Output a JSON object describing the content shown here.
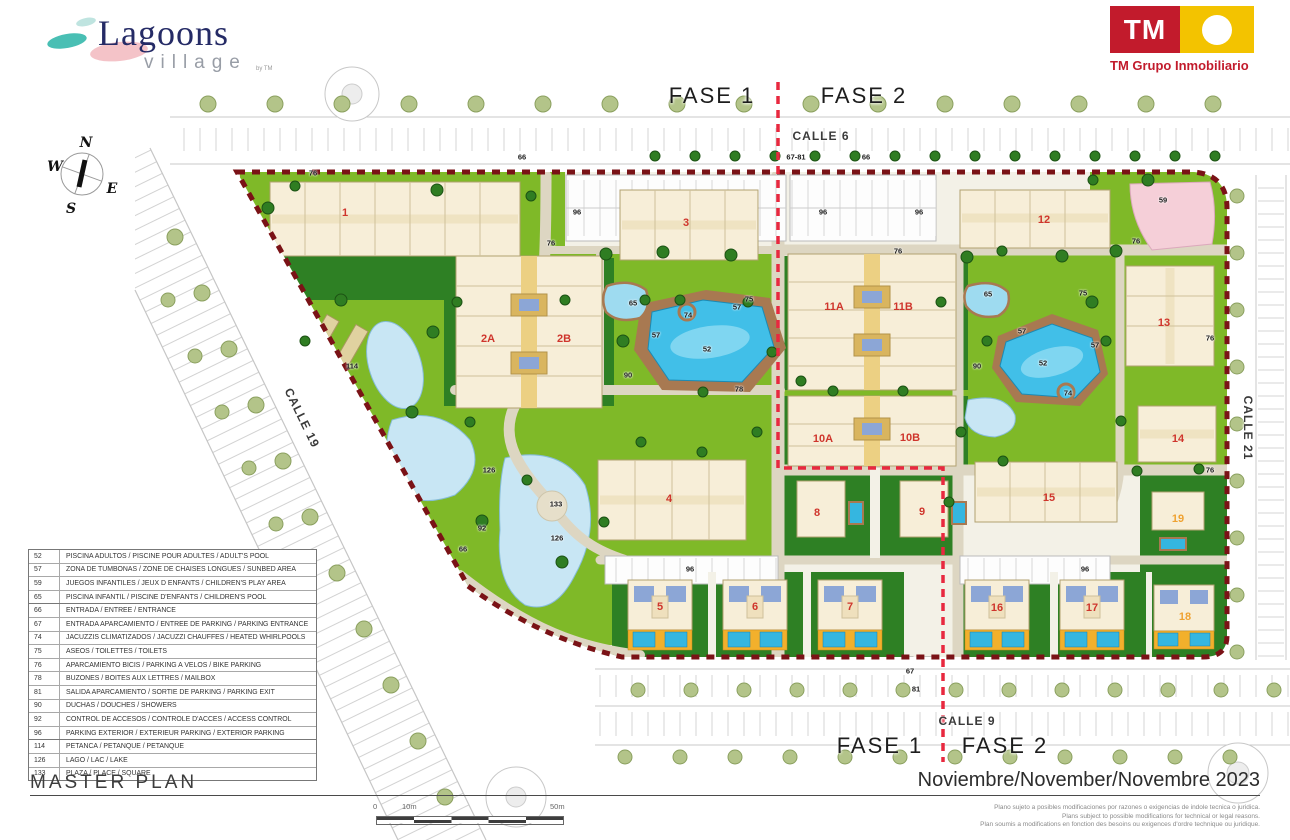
{
  "branding": {
    "lagoons_title": "Lagoons",
    "lagoons_subtitle": "village",
    "lagoons_by": "by TM",
    "tm_initials": "TM",
    "tm_company": "TM Grupo Inmobiliario"
  },
  "compass": {
    "n": "N",
    "w": "W",
    "e": "E",
    "s": "S"
  },
  "phases": {
    "top_left": "FASE 1",
    "top_right": "FASE 2",
    "bottom_left": "FASE 1",
    "bottom_right": "FASE 2"
  },
  "streets": {
    "top": "CALLE 6",
    "bottom": "CALLE 9",
    "left": "CALLE 19",
    "right": "CALLE 21"
  },
  "legend": {
    "items": [
      {
        "num": "52",
        "text": "PISCINA ADULTOS / PISCINE  POUR ADULTES / ADULT'S POOL"
      },
      {
        "num": "57",
        "text": "ZONA DE TUMBONAS / ZONE DE CHAISES LONGUES / SUNBED AREA"
      },
      {
        "num": "59",
        "text": "JUEGOS INFANTILES / JEUX D ENFANTS / CHILDREN'S PLAY AREA"
      },
      {
        "num": "65",
        "text": "PISCINA INFANTIL / PISCINE D'ENFANTS / CHILDREN'S POOL"
      },
      {
        "num": "66",
        "text": "ENTRADA / ENTREE / ENTRANCE"
      },
      {
        "num": "67",
        "text": "ENTRADA APARCAMIENTO / ENTREE DE PARKING / PARKING ENTRANCE"
      },
      {
        "num": "74",
        "text": "JACUZZIS CLIMATIZADOS / JACUZZI CHAUFFES / HEATED WHIRLPOOLS"
      },
      {
        "num": "75",
        "text": "ASEOS / TOILETTES / TOILETS"
      },
      {
        "num": "76",
        "text": "APARCAMIENTO BICIS / PARKING A VELOS / BIKE PARKING"
      },
      {
        "num": "78",
        "text": "BUZONES / BOITES AUX LETTRES / MAILBOX"
      },
      {
        "num": "81",
        "text": "SALIDA APARCAMIENTO / SORTIE DE PARKING / PARKING EXIT"
      },
      {
        "num": "90",
        "text": "DUCHAS / DOUCHES / SHOWERS"
      },
      {
        "num": "92",
        "text": "CONTROL DE ACCESOS / CONTROLE D'ACCES / ACCESS CONTROL"
      },
      {
        "num": "96",
        "text": "PARKING EXTERIOR / EXTERIEUR PARKING / EXTERIOR PARKING"
      },
      {
        "num": "114",
        "text": "PETANCA / PETANQUE / PETANQUE"
      },
      {
        "num": "126",
        "text": "LAGO / LAC / LAKE"
      },
      {
        "num": "133",
        "text": "PLAZA / PLACE / SQUARE"
      }
    ]
  },
  "map": {
    "building_labels": [
      {
        "label": "1",
        "x": 345,
        "y": 213
      },
      {
        "label": "2A",
        "x": 488,
        "y": 339
      },
      {
        "label": "2B",
        "x": 564,
        "y": 339
      },
      {
        "label": "3",
        "x": 686,
        "y": 223
      },
      {
        "label": "4",
        "x": 669,
        "y": 499
      },
      {
        "label": "5",
        "x": 660,
        "y": 607
      },
      {
        "label": "6",
        "x": 755,
        "y": 607
      },
      {
        "label": "7",
        "x": 850,
        "y": 607
      },
      {
        "label": "8",
        "x": 817,
        "y": 513
      },
      {
        "label": "9",
        "x": 922,
        "y": 512
      },
      {
        "label": "10A",
        "x": 823,
        "y": 439
      },
      {
        "label": "10B",
        "x": 910,
        "y": 438
      },
      {
        "label": "11A",
        "x": 834,
        "y": 307
      },
      {
        "label": "11B",
        "x": 903,
        "y": 307
      },
      {
        "label": "12",
        "x": 1044,
        "y": 220
      },
      {
        "label": "13",
        "x": 1164,
        "y": 323
      },
      {
        "label": "14",
        "x": 1178,
        "y": 439
      },
      {
        "label": "15",
        "x": 1049,
        "y": 498
      },
      {
        "label": "16",
        "x": 997,
        "y": 608
      },
      {
        "label": "17",
        "x": 1092,
        "y": 608
      },
      {
        "label": "18",
        "x": 1185,
        "y": 617,
        "accent": true
      },
      {
        "label": "19",
        "x": 1178,
        "y": 519,
        "accent": true
      }
    ],
    "markers": [
      {
        "label": "96",
        "x": 577,
        "y": 212
      },
      {
        "label": "96",
        "x": 823,
        "y": 212
      },
      {
        "label": "96",
        "x": 919,
        "y": 212
      },
      {
        "label": "96",
        "x": 690,
        "y": 569
      },
      {
        "label": "96",
        "x": 1085,
        "y": 569
      },
      {
        "label": "76",
        "x": 313,
        "y": 173
      },
      {
        "label": "76",
        "x": 551,
        "y": 243
      },
      {
        "label": "76",
        "x": 898,
        "y": 251
      },
      {
        "label": "76",
        "x": 1136,
        "y": 241
      },
      {
        "label": "76",
        "x": 1210,
        "y": 338
      },
      {
        "label": "76",
        "x": 1210,
        "y": 470
      },
      {
        "label": "66",
        "x": 522,
        "y": 157
      },
      {
        "label": "66",
        "x": 866,
        "y": 157
      },
      {
        "label": "66",
        "x": 463,
        "y": 549
      },
      {
        "label": "67-81",
        "x": 796,
        "y": 157
      },
      {
        "label": "67",
        "x": 910,
        "y": 671
      },
      {
        "label": "81",
        "x": 916,
        "y": 689
      },
      {
        "label": "52",
        "x": 707,
        "y": 349
      },
      {
        "label": "52",
        "x": 1043,
        "y": 363
      },
      {
        "label": "57",
        "x": 656,
        "y": 335
      },
      {
        "label": "57",
        "x": 737,
        "y": 307
      },
      {
        "label": "57",
        "x": 1022,
        "y": 331
      },
      {
        "label": "57",
        "x": 1095,
        "y": 345
      },
      {
        "label": "65",
        "x": 633,
        "y": 303
      },
      {
        "label": "65",
        "x": 988,
        "y": 294
      },
      {
        "label": "74",
        "x": 688,
        "y": 315
      },
      {
        "label": "74",
        "x": 1068,
        "y": 393
      },
      {
        "label": "75",
        "x": 749,
        "y": 299
      },
      {
        "label": "75",
        "x": 1083,
        "y": 293
      },
      {
        "label": "78",
        "x": 739,
        "y": 389
      },
      {
        "label": "90",
        "x": 628,
        "y": 375
      },
      {
        "label": "90",
        "x": 977,
        "y": 366
      },
      {
        "label": "92",
        "x": 482,
        "y": 528
      },
      {
        "label": "59",
        "x": 1163,
        "y": 200
      },
      {
        "label": "114",
        "x": 352,
        "y": 366
      },
      {
        "label": "126",
        "x": 489,
        "y": 470
      },
      {
        "label": "126",
        "x": 557,
        "y": 538
      },
      {
        "label": "133",
        "x": 556,
        "y": 504
      }
    ]
  },
  "footer": {
    "title": "MASTER PLAN",
    "date": "Noviembre/November/Novembre 2023",
    "disclaimers": [
      "Plano sujeto a posibles modificaciones por razones o exigencias de indole tecnica o juridica.",
      "Plans subject to possible modifications for technical or legal reasons.",
      "Plan soumis a modifications en fonction des besoins ou exigences d'ordre technique ou juridique."
    ],
    "scale": {
      "zero": "0",
      "ten": "10m",
      "fifty": "50m"
    }
  },
  "colors": {
    "boundary": "#7a1216",
    "phase_line": "#e8283f",
    "building_label": "#cf352c",
    "accent_label": "#efa231",
    "pool": "#41bfe8",
    "lake": "#c8e6f4",
    "lawn": "#7fb928",
    "dark_garden": "#2e8024",
    "deck": "#a87951",
    "tm_red": "#c21b2c",
    "tm_yellow": "#f3c300",
    "logo_navy": "#252b66",
    "logo_teal": "#49bfb4",
    "logo_pink": "#f4c3c8"
  }
}
